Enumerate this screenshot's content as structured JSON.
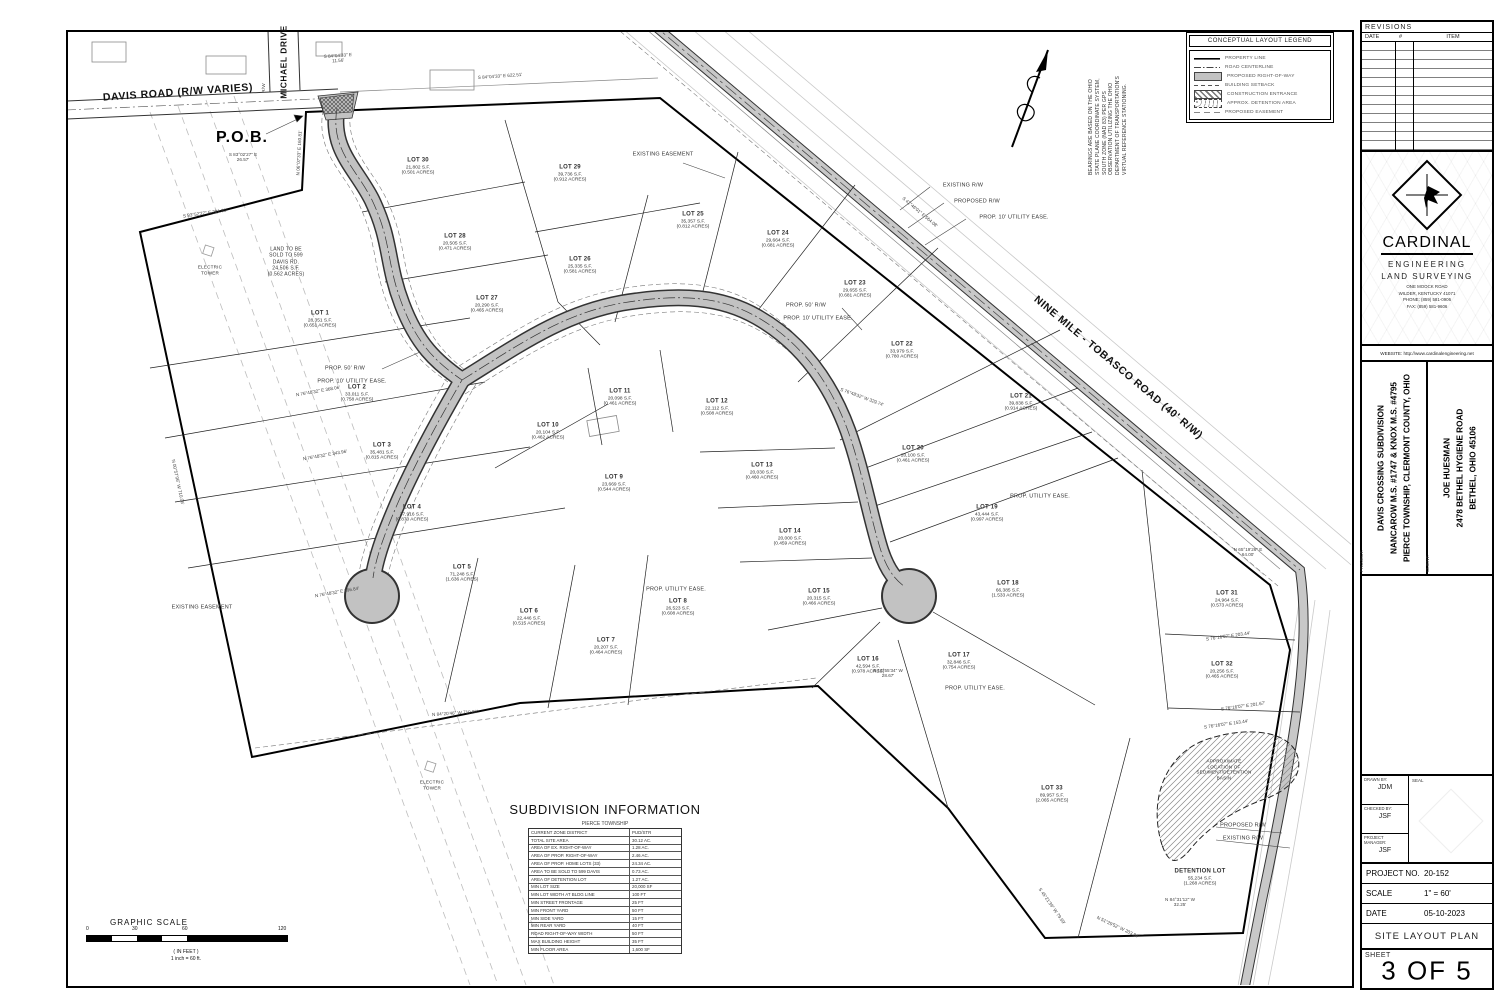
{
  "map": {
    "notes": "BEARINGS ARE BASED ON THE OHIO\nSTATE PLANE COORDINATE SYSTEM,\nSOUTH ZONE (NAD 83) PER GPS\nOBSERVATION UTILIZING THE OHIO\nDEPARTMENT OF TRANSPORTATION'S\nVIRTUAL REFERENCE STATIONING.",
    "lots": [
      {
        "n": "LOT 1",
        "sf": "28,351 S.F.",
        "ac": "(0.651 ACRES)",
        "x": 320,
        "y": 320
      },
      {
        "n": "LOT 2",
        "sf": "33,011 S.F.",
        "ac": "(0.758 ACRES)",
        "x": 357,
        "y": 394
      },
      {
        "n": "LOT 3",
        "sf": "35,481 S.F.",
        "ac": "(0.815 ACRES)",
        "x": 382,
        "y": 452
      },
      {
        "n": "LOT 4",
        "sf": "37,916 S.F.",
        "ac": "(0.870 ACRES)",
        "x": 412,
        "y": 514
      },
      {
        "n": "LOT 5",
        "sf": "71,248 S.F.",
        "ac": "(1.636 ACRES)",
        "x": 462,
        "y": 574
      },
      {
        "n": "LOT 6",
        "sf": "22,446 S.F.",
        "ac": "(0.515 ACRES)",
        "x": 529,
        "y": 618
      },
      {
        "n": "LOT 7",
        "sf": "20,207 S.F.",
        "ac": "(0.464 ACRES)",
        "x": 606,
        "y": 647
      },
      {
        "n": "LOT 8",
        "sf": "26,523 S.F.",
        "ac": "(0.608 ACRES)",
        "x": 678,
        "y": 608
      },
      {
        "n": "LOT 9",
        "sf": "23,669 S.F.",
        "ac": "(0.544 ACRES)",
        "x": 614,
        "y": 484
      },
      {
        "n": "LOT 10",
        "sf": "20,104 S.F.",
        "ac": "(0.462 ACRES)",
        "x": 548,
        "y": 432
      },
      {
        "n": "LOT 11",
        "sf": "20,098 S.F.",
        "ac": "(0.461 ACRES)",
        "x": 620,
        "y": 398
      },
      {
        "n": "LOT 12",
        "sf": "22,112 S.F.",
        "ac": "(0.508 ACRES)",
        "x": 717,
        "y": 408
      },
      {
        "n": "LOT 13",
        "sf": "20,030 S.F.",
        "ac": "(0.460 ACRES)",
        "x": 762,
        "y": 472
      },
      {
        "n": "LOT 14",
        "sf": "20,000 S.F.",
        "ac": "(0.459 ACRES)",
        "x": 790,
        "y": 538
      },
      {
        "n": "LOT 15",
        "sf": "20,315 S.F.",
        "ac": "(0.466 ACRES)",
        "x": 819,
        "y": 598
      },
      {
        "n": "LOT 16",
        "sf": "42,594 S.F.",
        "ac": "(0.978 ACRES)",
        "x": 868,
        "y": 666
      },
      {
        "n": "LOT 17",
        "sf": "32,846 S.F.",
        "ac": "(0.754 ACRES)",
        "x": 959,
        "y": 662
      },
      {
        "n": "LOT 18",
        "sf": "66,385 S.F.",
        "ac": "(1.533 ACRES)",
        "x": 1008,
        "y": 590
      },
      {
        "n": "LOT 19",
        "sf": "43,444 S.F.",
        "ac": "(0.997 ACRES)",
        "x": 987,
        "y": 514
      },
      {
        "n": "LOT 20",
        "sf": "20,100 S.F.",
        "ac": "(0.461 ACRES)",
        "x": 913,
        "y": 455
      },
      {
        "n": "LOT 21",
        "sf": "39,838 S.F.",
        "ac": "(0.914 ACRES)",
        "x": 1021,
        "y": 403
      },
      {
        "n": "LOT 22",
        "sf": "33,979 S.F.",
        "ac": "(0.780 ACRES)",
        "x": 902,
        "y": 351
      },
      {
        "n": "LOT 23",
        "sf": "29,655 S.F.",
        "ac": "(0.681 ACRES)",
        "x": 855,
        "y": 290
      },
      {
        "n": "LOT 24",
        "sf": "29,664 S.F.",
        "ac": "(0.681 ACRES)",
        "x": 778,
        "y": 240
      },
      {
        "n": "LOT 25",
        "sf": "35,357 S.F.",
        "ac": "(0.812 ACRES)",
        "x": 693,
        "y": 221
      },
      {
        "n": "LOT 26",
        "sf": "25,335 S.F.",
        "ac": "(0.581 ACRES)",
        "x": 580,
        "y": 266
      },
      {
        "n": "LOT 27",
        "sf": "20,290 S.F.",
        "ac": "(0.465 ACRES)",
        "x": 487,
        "y": 305
      },
      {
        "n": "LOT 28",
        "sf": "20,505 S.F.",
        "ac": "(0.471 ACRES)",
        "x": 455,
        "y": 243
      },
      {
        "n": "LOT 29",
        "sf": "39,736 S.F.",
        "ac": "(0.912 ACRES)",
        "x": 570,
        "y": 174
      },
      {
        "n": "LOT 30",
        "sf": "21,802 S.F.",
        "ac": "(0.501 ACRES)",
        "x": 418,
        "y": 167
      },
      {
        "n": "LOT 31",
        "sf": "24,964 S.F.",
        "ac": "(0.573 ACRES)",
        "x": 1227,
        "y": 600
      },
      {
        "n": "LOT 32",
        "sf": "20,256 S.F.",
        "ac": "(0.465 ACRES)",
        "x": 1222,
        "y": 671
      },
      {
        "n": "LOT 33",
        "sf": "89,957 S.F.",
        "ac": "(2.065 ACRES)",
        "x": 1052,
        "y": 795
      },
      {
        "n": "DETENTION LOT",
        "sf": "55,234 S.F.",
        "ac": "(1.268 ACRES)",
        "x": 1200,
        "y": 878
      }
    ],
    "annotations": [
      {
        "t": "DAVIS ROAD (R/W VARIES)",
        "x": 178,
        "y": 93,
        "rot": -4,
        "cls": "road"
      },
      {
        "t": "MICHAEL DRIVE",
        "x": 284,
        "y": 62,
        "rot": -90,
        "cls": "roadsm"
      },
      {
        "t": "R/W",
        "x": 264,
        "y": 88,
        "rot": -90,
        "cls": "tiny"
      },
      {
        "t": "NINE MILE - TOBASCO ROAD (40' R/W)",
        "x": 1118,
        "y": 368,
        "rot": 40,
        "cls": "road"
      },
      {
        "t": "P.O.B.",
        "x": 242,
        "y": 138,
        "cls": "pob"
      },
      {
        "t": "EXISTING\nEASEMENT",
        "x": 663,
        "y": 155,
        "cls": "note"
      },
      {
        "t": "EXISTING EASEMENT",
        "x": 202,
        "y": 608,
        "cls": "note"
      },
      {
        "t": "EXISTING R/W",
        "x": 963,
        "y": 186,
        "cls": "note"
      },
      {
        "t": "PROPOSED R/W",
        "x": 977,
        "y": 202,
        "cls": "note"
      },
      {
        "t": "PROP. 10' UTILITY EASE.",
        "x": 1014,
        "y": 218,
        "cls": "note"
      },
      {
        "t": "PROP. 50' R/W",
        "x": 345,
        "y": 369,
        "cls": "note"
      },
      {
        "t": "PROP. 10' UTILITY EASE.",
        "x": 352,
        "y": 382,
        "cls": "note"
      },
      {
        "t": "PROP. 50' R/W",
        "x": 806,
        "y": 306,
        "cls": "note"
      },
      {
        "t": "PROP. 10' UTILITY EASE.",
        "x": 818,
        "y": 319,
        "cls": "note"
      },
      {
        "t": "PROP. UTILITY EASE.",
        "x": 676,
        "y": 590,
        "cls": "note"
      },
      {
        "t": "PROP. UTILITY EASE.",
        "x": 1040,
        "y": 497,
        "cls": "note"
      },
      {
        "t": "PROP. UTILITY EASE.",
        "x": 975,
        "y": 689,
        "cls": "note"
      },
      {
        "t": "PROPOSED R/W",
        "x": 1243,
        "y": 826,
        "cls": "note"
      },
      {
        "t": "EXISTING R/W",
        "x": 1243,
        "y": 839,
        "cls": "note"
      },
      {
        "t": "ELECTRIC\nTOWER",
        "x": 210,
        "y": 270,
        "cls": "tinynote"
      },
      {
        "t": "ELECTRIC\nTOWER",
        "x": 432,
        "y": 785,
        "cls": "tinynote"
      },
      {
        "t": "LAND TO BE\nSOLD TO 599\nDAVIS RD.\n24,506 S.F.\n(0.562 ACRES)",
        "x": 286,
        "y": 262,
        "cls": "parceltext"
      },
      {
        "t": "APPROXIMATE\nLOCATION OF\nSEDIMENT/DETENTION\nBASIN",
        "x": 1224,
        "y": 770,
        "cls": "tinynote"
      }
    ],
    "bearings": [
      {
        "t": "S 84°04'33\" E  622.51'",
        "x": 500,
        "y": 76,
        "rot": -4
      },
      {
        "t": "S 84°04'33\" E\n11.56'",
        "x": 338,
        "y": 58,
        "rot": -4
      },
      {
        "t": "S 83°02'27\" E\n26.57'",
        "x": 243,
        "y": 157
      },
      {
        "t": "S 83°52'27\" E  201.81'",
        "x": 205,
        "y": 213,
        "rot": -8
      },
      {
        "t": "N 06°07'33\" E  160.81'",
        "x": 299,
        "y": 153,
        "rot": -87
      },
      {
        "t": "S 42°46'01\" E  564.08'",
        "x": 920,
        "y": 212,
        "rot": 40
      },
      {
        "t": "N 00°57'06\" W  710.06'",
        "x": 178,
        "y": 482,
        "rot": 78
      },
      {
        "t": "N 84°20'46\" W  710.86'",
        "x": 455,
        "y": 713,
        "rot": -4
      },
      {
        "t": "N 76°48'32\" E  368.06'",
        "x": 318,
        "y": 391,
        "rot": -10
      },
      {
        "t": "N 76°48'32\" E  343.96'",
        "x": 325,
        "y": 455,
        "rot": -10
      },
      {
        "t": "N 76°48'32\" E  396.84'",
        "x": 337,
        "y": 592,
        "rot": -10
      },
      {
        "t": "S 12°55'34\" W\n28.67'",
        "x": 888,
        "y": 673
      },
      {
        "t": "N 84°31'12\" W\n32.25'",
        "x": 1180,
        "y": 902
      },
      {
        "t": "N 65°19'26\" E\n64.00'",
        "x": 1248,
        "y": 552
      },
      {
        "t": "S 76°16'07\" E  203.44'",
        "x": 1228,
        "y": 636,
        "rot": -8
      },
      {
        "t": "S 76°16'07\" E  153.44'",
        "x": 1226,
        "y": 724,
        "rot": -8
      },
      {
        "t": "S 76°16'07\" E  201.67'",
        "x": 1243,
        "y": 706,
        "rot": -8
      },
      {
        "t": "S 76°48'32\" W  329.74'",
        "x": 862,
        "y": 397,
        "rot": 20
      },
      {
        "t": "S 45°21'39\" W  79.69'",
        "x": 1052,
        "y": 906,
        "rot": 55
      },
      {
        "t": "N 51°29'52\" W  203.94'",
        "x": 1118,
        "y": 927,
        "rot": 25
      }
    ]
  },
  "legend": {
    "title": "CONCEPTUAL LAYOUT LEGEND",
    "items": [
      {
        "label": "PROPERTY LINE",
        "cls": "sw-property"
      },
      {
        "label": "ROAD CENTERLINE",
        "cls": "sw-centerline"
      },
      {
        "label": "PROPOSED RIGHT-OF-WAY",
        "cls": "sw-row"
      },
      {
        "label": "BUILDING SETBACK",
        "cls": "sw-setback"
      },
      {
        "label": "CONSTRUCTION ENTRANCE",
        "cls": "sw-constr"
      },
      {
        "label": "APPROX. DETENTION AREA",
        "cls": "sw-detention"
      },
      {
        "label": "PROPOSED EASEMENT",
        "cls": "sw-easement"
      }
    ]
  },
  "subdivision_info": {
    "title": "SUBDIVISION INFORMATION",
    "township": "PIERCE TOWNSHIP",
    "rows": [
      {
        "l": "CURRENT ZONE DISTRICT",
        "v": "PUD/STR"
      },
      {
        "l": "TOTAL SITE AREA",
        "v": "30.12 AC."
      },
      {
        "l": "AREA OF EX. RIGHT-OF-WAY",
        "v": "1.28 AC."
      },
      {
        "l": "AREA OF PROP. RIGHT-OF-WAY",
        "v": "2.46 AC."
      },
      {
        "l": "AREA OF PROP. HOME LOTS (33)",
        "v": "24.34 AC."
      },
      {
        "l": "AREA TO BE SOLD TO 599 DAVIS",
        "v": "0.73 AC."
      },
      {
        "l": "AREA OF DETENTION LOT",
        "v": "1.27 AC."
      },
      {
        "l": "MIN LOT SIZE",
        "v": "20,000 SF"
      },
      {
        "l": "MIN LOT WIDTH AT BLDG LINE",
        "v": "100 FT"
      },
      {
        "l": "MIN STREET FRONTAGE",
        "v": "25 FT"
      },
      {
        "l": "MIN FRONT YARD",
        "v": "50 FT"
      },
      {
        "l": "MIN SIDE YARD",
        "v": "15 FT"
      },
      {
        "l": "MIN REAR YARD",
        "v": "40 FT"
      },
      {
        "l": "ROAD RIGHT-OF-WAY WIDTH",
        "v": "50 FT"
      },
      {
        "l": "MAX BUILDING HEIGHT",
        "v": "35 FT"
      },
      {
        "l": "MIN FLOOR AREA",
        "v": "1,600 SF"
      }
    ]
  },
  "scalebar": {
    "title": "GRAPHIC SCALE",
    "ticks": [
      "0",
      "30",
      "60",
      "120"
    ],
    "unit": "( IN FEET )",
    "note": "1 inch = 60 ft."
  },
  "titleblock": {
    "revisions": {
      "title": "REVISIONS",
      "date": "DATE",
      "num": "#",
      "item": "ITEM"
    },
    "firm": {
      "name": "CARDINAL",
      "line1": "ENGINEERING",
      "line2": "LAND SURVEYING",
      "addr1": "ONE MOOCK ROAD",
      "addr2": "WILDER, KENTUCKY 41071",
      "addr3": "PHONE: (859) 581-0906",
      "addr4": "FAX: (859) 581-9606",
      "website": "WEBSITE: http://www.cardinalengineering.net"
    },
    "project": {
      "label": "PROJECT:",
      "line1": "DAVIS CROSSING SUBDIVISION",
      "line2": "NANCAROW M.S. #1747 & KNOX M.S. #4795",
      "line3": "PIERCE TOWNSHIP, CLERMONT COUNTY, OHIO"
    },
    "client": {
      "label": "CLIENT:",
      "line1": "JOE HUESMAN",
      "line2": "2478 BETHEL HYGIENE ROAD",
      "line3": "BETHEL, OHIO 45106"
    },
    "credits": {
      "drawn_label": "DRAWN BY:",
      "drawn": "JDM",
      "checked_label": "CHECKED BY:",
      "checked": "JSF",
      "pm_label": "PROJECT\nMANAGER:",
      "pm": "JSF",
      "seal_label": "SEAL"
    },
    "meta": {
      "project_no_label": "PROJECT NO.",
      "project_no": "20-152",
      "scale_label": "SCALE",
      "scale": "1\" = 60'",
      "date_label": "DATE",
      "date": "05-10-2023"
    },
    "plan_title": "SITE LAYOUT PLAN",
    "sheet_label": "SHEET",
    "sheet": "3 OF 5"
  }
}
